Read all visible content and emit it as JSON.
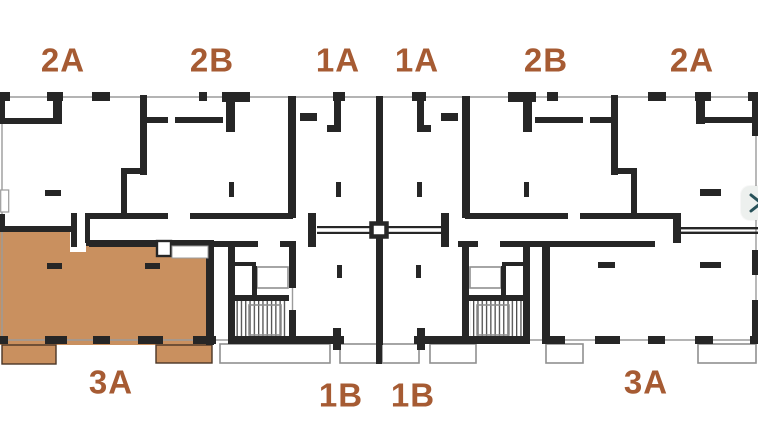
{
  "plan": {
    "view": "floor-plan",
    "highlighted_unit": "3A",
    "colors": {
      "highlight": "#c9905f",
      "wall": "#262626",
      "thin-line": "#9b9b9b",
      "label": "#a65b33",
      "button-bg": "#edf0ee",
      "button-icon": "#28525a"
    },
    "unit_labels": [
      {
        "label": "2A",
        "row": "top",
        "highlighted": false
      },
      {
        "label": "2B",
        "row": "top",
        "highlighted": false
      },
      {
        "label": "1A",
        "row": "top",
        "highlighted": false
      },
      {
        "label": "1A",
        "row": "top",
        "highlighted": false
      },
      {
        "label": "2B",
        "row": "top",
        "highlighted": false
      },
      {
        "label": "2A",
        "row": "top",
        "highlighted": false
      },
      {
        "label": "3A",
        "row": "bottom",
        "highlighted": true
      },
      {
        "label": "1B",
        "row": "bottom",
        "highlighted": false
      },
      {
        "label": "1B",
        "row": "bottom",
        "highlighted": false
      },
      {
        "label": "3A",
        "row": "bottom",
        "highlighted": false
      }
    ],
    "next_button": {
      "icon": "chevron-right"
    }
  }
}
